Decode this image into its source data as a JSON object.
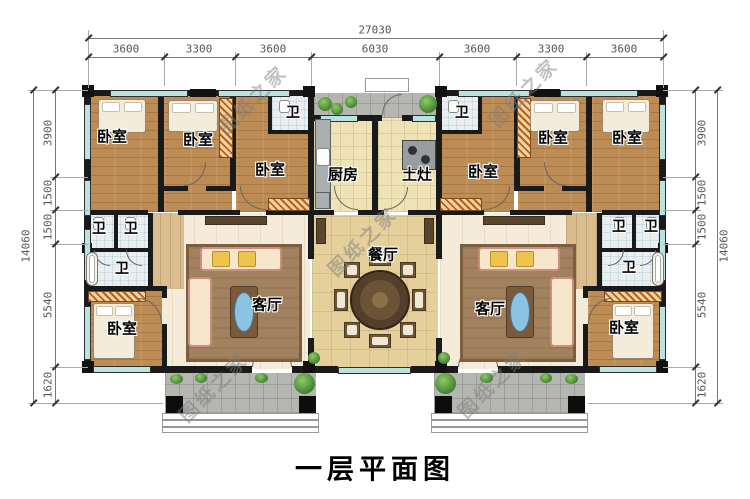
{
  "title": "一层平面图",
  "watermark": "图纸之家",
  "rooms": {
    "bedroom": "卧室",
    "bath": "卫",
    "kitchen": "厨房",
    "stove": "土灶",
    "dining": "餐厅",
    "living": "客厅"
  },
  "dims": {
    "top_total": "27030",
    "top_segments": [
      "3600",
      "3300",
      "3600",
      "6030",
      "3600",
      "3300",
      "3600"
    ],
    "left_total": "14060",
    "left_segments": [
      "3900",
      "1500",
      "1500",
      "5540",
      "1620"
    ],
    "right_total": "14060",
    "right_segments": [
      "3900",
      "1500",
      "1500",
      "5540",
      "1620"
    ]
  }
}
